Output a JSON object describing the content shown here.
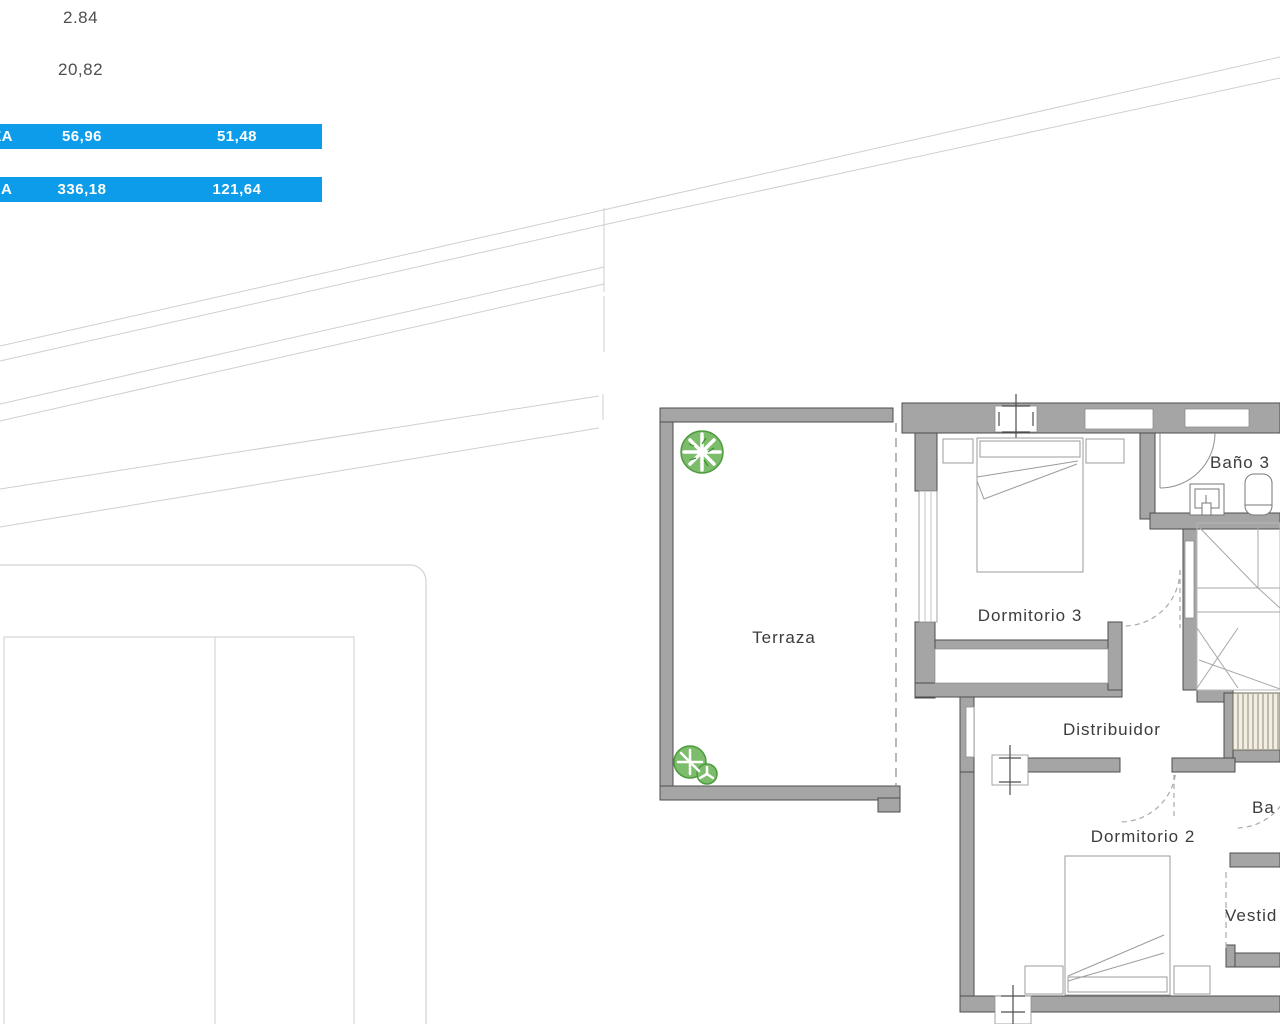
{
  "measurements": {
    "value_top": "2.84",
    "value_bottom": "20,82"
  },
  "area_table": {
    "row_bg": "#0d9ce9",
    "text_color": "#ffffff",
    "rows": [
      {
        "label_fragment": "ZA",
        "col1": "56,96",
        "col2": "51,48"
      },
      {
        "label_fragment": "A",
        "col1": "336,18",
        "col2": "121,64"
      }
    ]
  },
  "floor_plan": {
    "rooms": [
      {
        "id": "terraza",
        "label": "Terraza"
      },
      {
        "id": "dormitorio3",
        "label": "Dormitorio 3"
      },
      {
        "id": "bano3",
        "label": "Baño 3"
      },
      {
        "id": "distribuidor",
        "label": "Distribuidor"
      },
      {
        "id": "dormitorio2",
        "label": "Dormitorio 2"
      },
      {
        "id": "bano2",
        "label_fragment": "Ba"
      },
      {
        "id": "vestidor",
        "label_fragment": "Vestid"
      }
    ],
    "symbols": [
      "tree-plant",
      "bush-plant",
      "double-bed",
      "nightstand",
      "window-marker",
      "door-arc",
      "stairs",
      "sink",
      "toilet"
    ],
    "colors": {
      "wall_fill": "#a5a5a5",
      "wall_stroke": "#4d4d4d",
      "furniture_line": "#9b9b9b",
      "roof_line": "#cfcfcf",
      "plant_green": "#7cbd6b",
      "plant_dark_green": "#3f8f36",
      "stair_hatch_bg": "#f2eee2",
      "stair_hatch_line": "#8f887a"
    }
  }
}
